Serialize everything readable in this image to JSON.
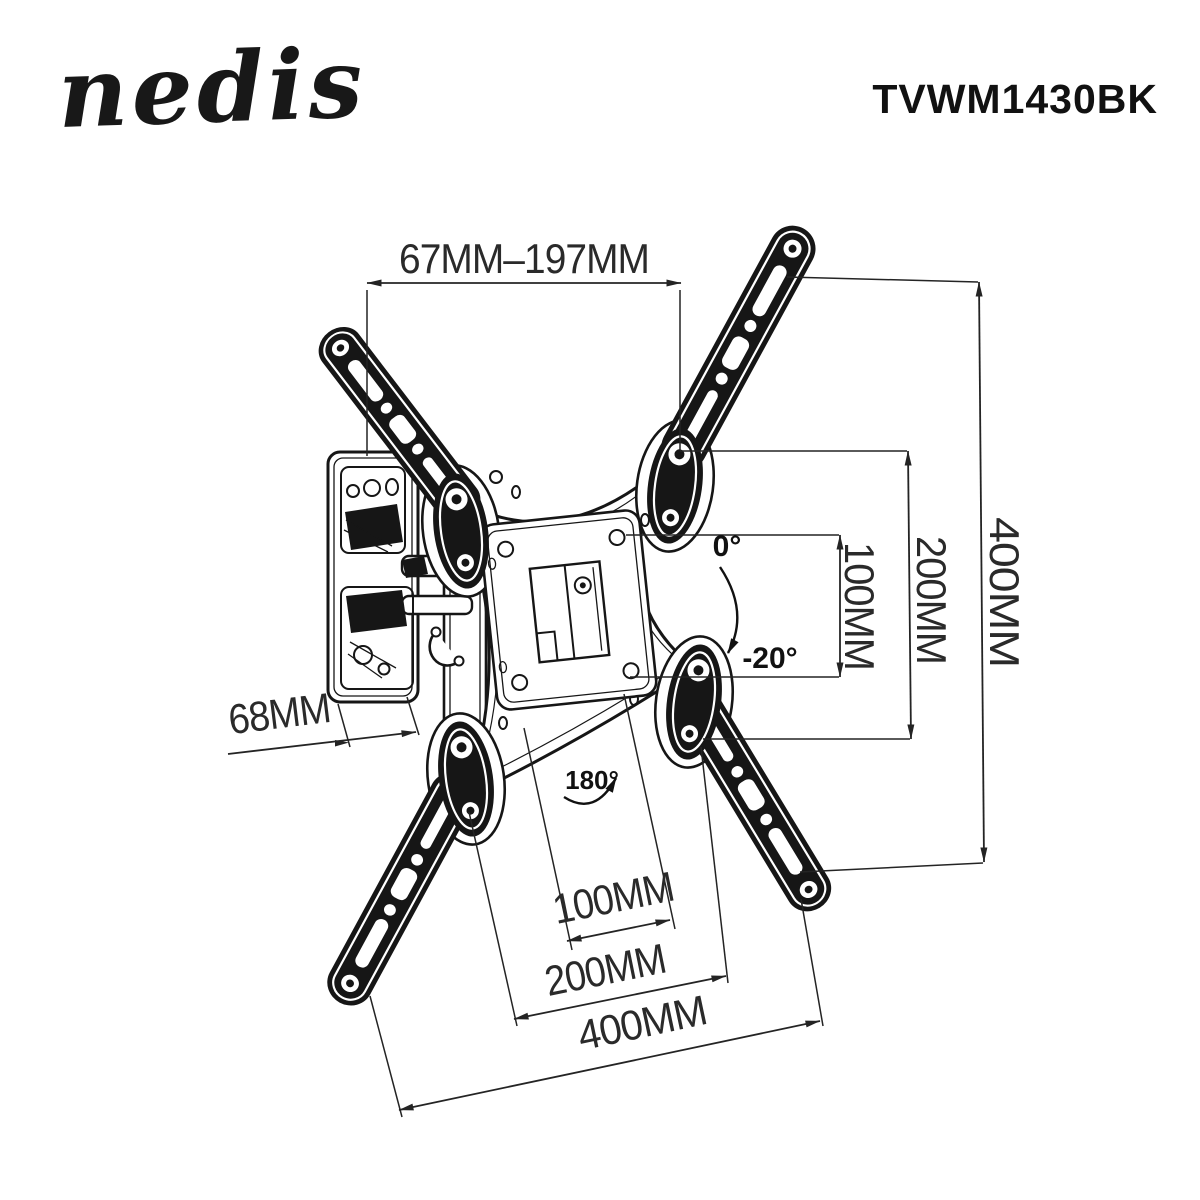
{
  "page": {
    "background": "#ffffff"
  },
  "header": {
    "logo": "nedis",
    "model": "TVWM1430BK"
  },
  "dimensions": {
    "top_extension_range": "67MM–197MM",
    "right_vesa_height": "100MM",
    "right_pivot_height": "200MM",
    "right_overall_height": "400MM",
    "wall_plate_depth": "68MM",
    "bottom_vesa_width": "100MM",
    "bottom_pivot_width": "200MM",
    "bottom_overall_width": "400MM"
  },
  "angles": {
    "tilt_from": "0°",
    "tilt_to": "-20°",
    "swivel": "180°"
  },
  "colors": {
    "ink": "#1a1a1a",
    "background": "#ffffff"
  }
}
